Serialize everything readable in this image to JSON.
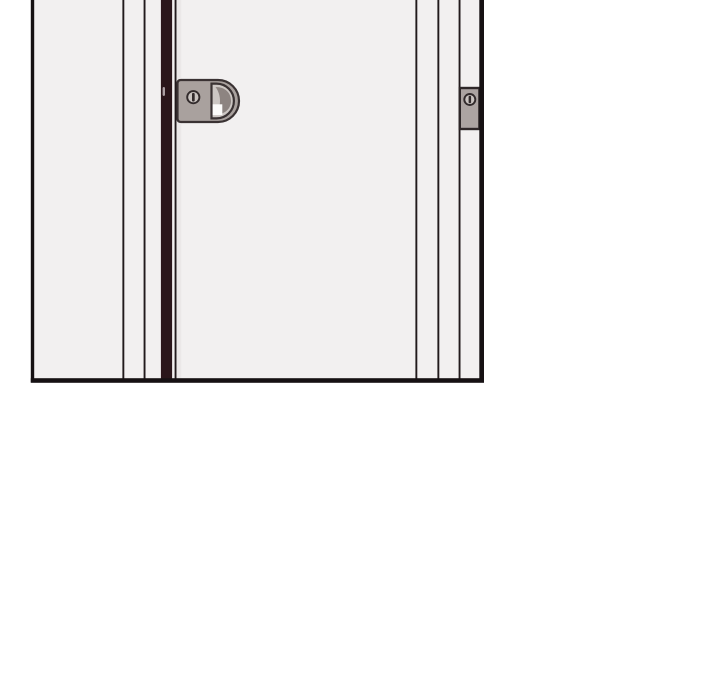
{
  "scene": {
    "panel_kind": "comic-panel",
    "depicts": "closed door with latch handle, door gap and strike plate"
  },
  "colors": {
    "page_background": "#ffffff",
    "panel_surface": "#f2f0f0",
    "panel_border": "#161113",
    "frame_line": "#221a1c",
    "door_gap": "#2a161a",
    "door_gap_highlight": "#ab9fa2",
    "door_edge_shadow": "#ebe8e8",
    "hardware_gray": "#a9a19e",
    "hardware_outline": "#3a3233",
    "latch_recess_light": "#ccc6c3",
    "latch_recess_shadow": "#8d8481",
    "latch_highlight": "#fcfbfa",
    "screw_face": "#c9c3c0",
    "screw_slot": "#322b2c",
    "strike_plate_gray": "#aca4a2"
  }
}
